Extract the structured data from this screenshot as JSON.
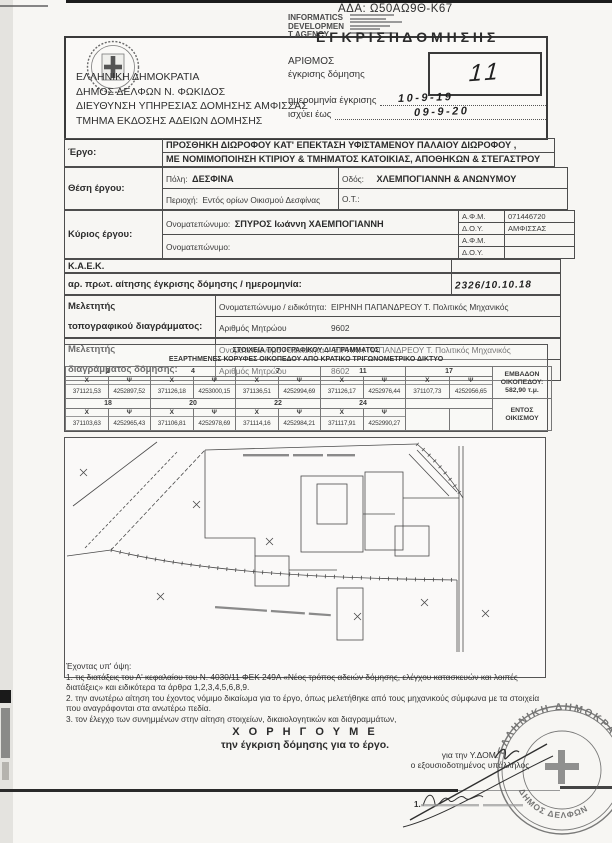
{
  "page": {
    "ada": "ΑΔΑ: Ω50ΑΩ9Θ-Κ67"
  },
  "digital_stamp": {
    "line1": "INFORMATICS",
    "line2": "DEVELOPMEN",
    "line3": "T AGENCY"
  },
  "header": {
    "authority": [
      "ΕΛΛΗΝΙΚΗ ΔΗΜΟΚΡΑΤΙΑ",
      "ΔΗΜΟΣ ΔΕΛΦΩΝ Ν. ΦΩΚΙΔΟΣ",
      "ΔΙΕΥΘΥΝΣΗ ΥΠΗΡΕΣΙΑΣ ΔΟΜΗΣΗΣ ΑΜΦΙΣΣΑΣ",
      "ΤΜΗΜΑ ΕΚΔΟΣΗΣ ΑΔΕΙΩΝ ΔΟΜΗΣΗΣ"
    ],
    "title": "Ε Γ Κ Ρ Ι Σ Η   Δ Ο Μ Η Σ Η Σ",
    "number_label_1": "ΑΡΙΘΜΟΣ",
    "number_label_2": "έγκρισης δόμησης",
    "number_value": "11",
    "date_label": "ημερομηνία έγκρισης",
    "date_value": "10-9-19",
    "valid_label": "ισχύει έως",
    "valid_value": "09-9-20"
  },
  "details": {
    "project_label": "Έργο:",
    "project_line1": "ΠΡΟΣΘΗΚΗ ΔΙΩΡΟΦΟΥ ΚΑΤ' ΕΠΕΚΤΑΣΗ ΥΦΙΣΤΑΜΕΝΟΥ ΠΑΛΑΙΟΥ ΔΙΩΡΟΦΟΥ ,",
    "project_line2": "ΜΕ ΝΟΜΙΜΟΠΟΙΗΣΗ ΚΤΙΡΙΟΥ & ΤΜΗΜΑΤΟΣ ΚΑΤΟΙΚΙΑΣ, ΑΠΟΘΗΚΩΝ & ΣΤΕΓΑΣΤΡΟΥ",
    "location_label": "Θέση έργου:",
    "city_label": "Πόλη:",
    "city_value": "ΔΕΣΦΙΝΑ",
    "street_label": "Οδός:",
    "street_value": "ΧΛΕΜΠΟΓΙΑΝΝΗ & ΑΝΩΝΥΜΟΥ",
    "region_label": "Περιοχή:",
    "region_value": "Εντός ορίων Οικισμού Δεσφίνας",
    "ot_label": "Ο.Τ.:",
    "owner_label": "Κύριος έργου:",
    "owner_name_label": "Ονοματεπώνυμο:",
    "owner_name_value": "ΣΠΥΡΟΣ Ιωάννη ΧΑΕΜΠΟΓΙΑΝΝΗ",
    "afm_label": "Α.Φ.Μ.",
    "afm_value": "071446720",
    "doy_label": "Δ.Ο.Υ.",
    "doy_value": "ΑΜΦΙΣΣΑΣ",
    "owner2_name_label": "Ονοματεπώνυμο:",
    "afm2_label": "Α.Φ.Μ.",
    "doy2_label": "Δ.Ο.Υ.",
    "kaek_label": "Κ.Α.Ε.Κ.",
    "protocol_label": "αρ. πρωτ. αίτησης έγκρισης δόμησης / ημερομηνία:",
    "protocol_value": "2326/10.10.18",
    "surveyor1_label1": "Μελετητής",
    "surveyor1_label2": "τοπογραφικού διαγράμματος:",
    "surveyor1_name_label": "Ονοματεπώνυμο / ειδικότητα:",
    "surveyor1_name_value": "ΕΙΡΗΝΗ ΠΑΠΑΝΔΡΕΟΥ   Τ. Πολιτικός Μηχανικός",
    "surveyor1_reg_label": "Αριθμός Μητρώου",
    "surveyor1_reg_value": "9602",
    "surveyor2_label1": "Μελετητής",
    "surveyor2_label2": "διαγράμματος δόμησης:",
    "surveyor2_name_label": "Ονοματεπώνυμο / ειδικότητα :",
    "surveyor2_name_value": "ΕΙΡΗΝΗ ΠΑΠΑΝΔΡΕΟΥ   Τ. Πολιτικός Μηχανικός",
    "surveyor2_reg_label": "Αριθμός Μητρώου",
    "surveyor2_reg_value": "8602"
  },
  "coords": {
    "title": "ΣΤΟΙΧΕΙΑ ΤΟΠΟΓΡΑΦΙΚΟΥ ΔΙΑΓΡΑΜΜΑΤΟΣ",
    "subtitle": "ΕΞΑΡΤΗΜΕΝΕΣ ΚΟΡΥΦΕΣ ΟΙΚΟΠΕΔΟΥ ΑΠΟ ΚΡΑΤΙΚΟ ΤΡΙΓΩΝΟΜΕΤΡΙΚΟ ΔΙΚΤΥΟ",
    "x_label": "X",
    "y_label": "Ψ",
    "area_1": "ΕΜΒΑΔΟΝ",
    "area_2": "ΟΙΚΟΠΕΔΟΥ:",
    "area_value": "582,90 τ.μ.",
    "zone_1": "ΕΝΤΟΣ",
    "zone_2": "ΟΙΚΙΣΜΟΥ",
    "r1": [
      {
        "n": "1",
        "x": "371121,53",
        "y": "4252897,52"
      },
      {
        "n": "4",
        "x": "371126,18",
        "y": "4253000,15"
      },
      {
        "n": "7",
        "x": "371136,51",
        "y": "4252994,69"
      },
      {
        "n": "11",
        "x": "371126,17",
        "y": "4252976,44"
      },
      {
        "n": "17",
        "x": "371107,73",
        "y": "4252956,65"
      }
    ],
    "r2": [
      {
        "n": "18",
        "x": "371103,63",
        "y": "4252965,43"
      },
      {
        "n": "20",
        "x": "371106,81",
        "y": "4252978,69"
      },
      {
        "n": "22",
        "x": "371114,16",
        "y": "4252984,21"
      },
      {
        "n": "24",
        "x": "371117,91",
        "y": "4252990,27"
      }
    ]
  },
  "footer": {
    "having_regard": "Έχοντας υπ' όψη:",
    "item1a": "1. τις διατάξεις του Α' κεφαλαίου του Ν. 4030/11 ΦΕΚ 249Α «Νέος τρόπος αδειών δόμησης, ελέγχου κατασκευών και λοιπές",
    "item1b": "διατάξεις» και ειδικότερα τα άρθρα 1,2,3,4,5,6,8,9.",
    "item2a": "2. την ανωτέρω αίτηση του έχοντος νόμιμο δικαίωμα για το έργο, όπως μελετήθηκε από τους μηχανικούς σύμφωνα με τα στοιχεία",
    "item2b": "που αναγράφονται στα ανωτέρω πεδία.",
    "item3": "3. τον έλεγχο των συνημμένων στην αίτηση στοιχείων, δικαιολογητικών και διαγραμμάτων,",
    "grant_word": "Χ Ο Ρ Η Γ Ο Υ Μ Ε",
    "grant_line": "την έγκριση δόμησης για το έργο.",
    "for_ydom": "για την Υ.ΔΟΜ.",
    "authorized": "ο εξουσιοδοτημένος υπάλληλος",
    "signature_prefix": "1.",
    "stamp_outer": "ΕΛΛΗΝΙΚΗ ΔΗΜΟΚΡΑΤΙΑ",
    "stamp_inner": "ΔΗΜΟΣ ΔΕΛΦΩΝ"
  }
}
